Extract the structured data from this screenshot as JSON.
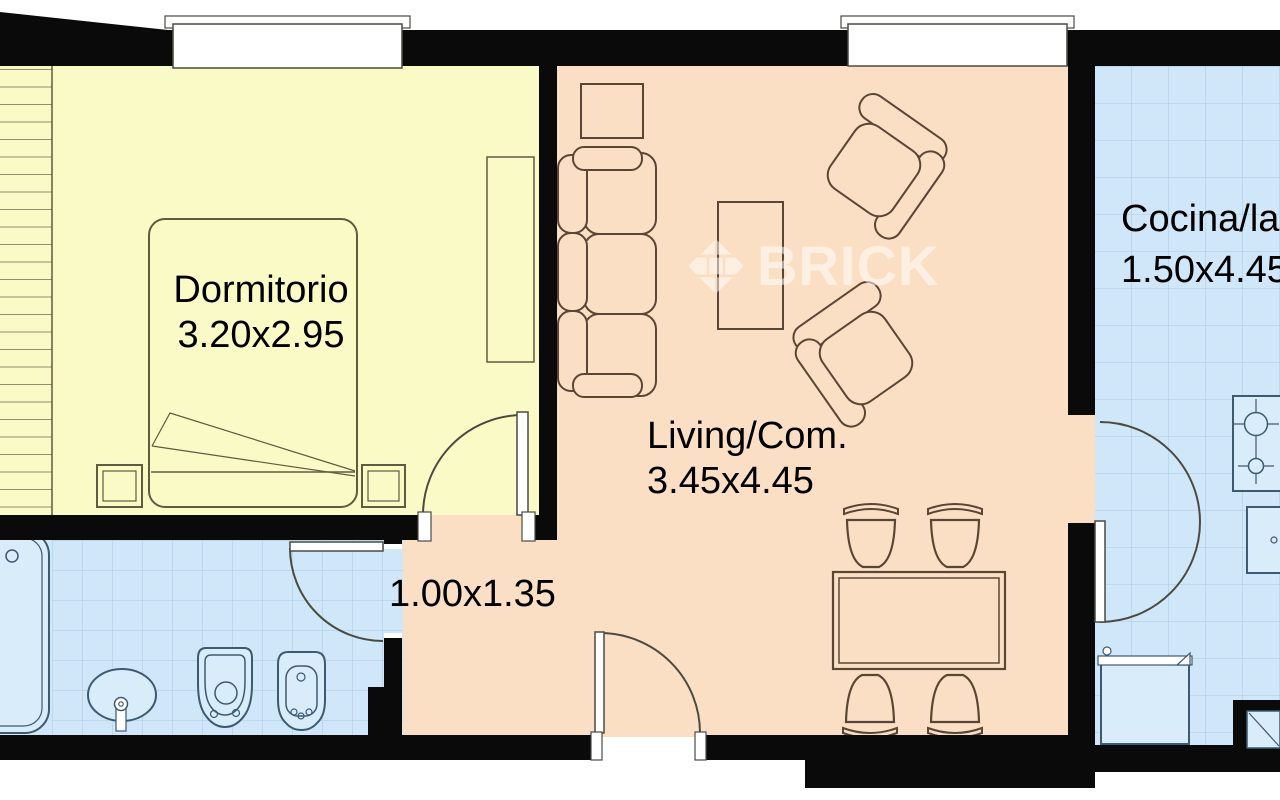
{
  "plan": {
    "watermark": {
      "text": "BRICK",
      "logo_icon": "brick-diamond-logo"
    },
    "rooms": {
      "bedroom": {
        "name": "Dormitorio",
        "dims": "3.20x2.95"
      },
      "living": {
        "name": "Living/Com.",
        "dims": "3.45x4.45"
      },
      "hall": {
        "dims": "1.00x1.35"
      },
      "kitchen": {
        "name": "Cocina/la",
        "dims": "1.50x4.45",
        "fixture_icons": [
          "stove-icon",
          "sink-icon",
          "washing-machine-icon",
          "laundry-sink-icon"
        ]
      },
      "bathroom": {
        "fixture_icons": [
          "bathtub-icon",
          "washbasin-icon",
          "toilet-icon",
          "bidet-icon"
        ]
      }
    },
    "colors": {
      "wall": "#0a0a0a",
      "bedroom": "#fafac6",
      "living": "#fbdfc4",
      "wet": "#cfe7f8",
      "grid": "#a9c9df",
      "fixture": "#d8ecf9"
    }
  }
}
